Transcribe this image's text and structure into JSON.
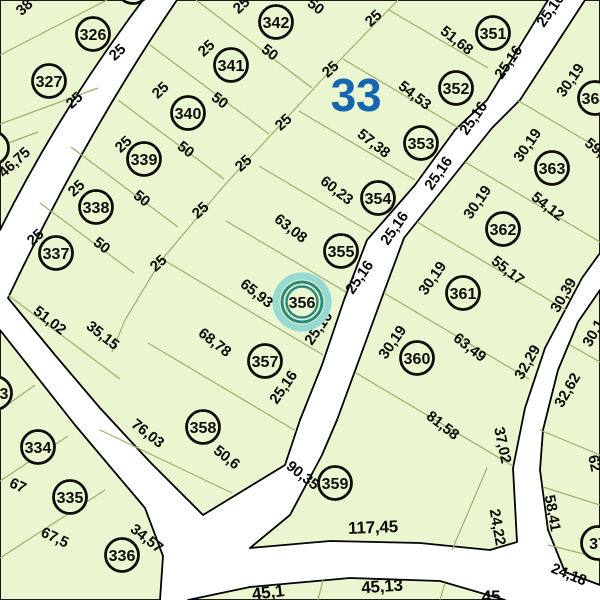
{
  "map": {
    "block_number": "33",
    "colors": {
      "parcel_fill": "#eaf6cf",
      "road": "#ffffff",
      "block_number_blue": "#1566b0",
      "highlight_teal_dark": "#2a8a7e",
      "highlight_teal_light": "#96d9d1",
      "highlight_text": "#1e7066",
      "line_olive": "#9fae6e",
      "text": "#0a0a0a"
    },
    "selected_parcel": "356",
    "parcel_markers": [
      {
        "num": "326",
        "x": 93,
        "y": 34
      },
      {
        "num": "327",
        "x": 49,
        "y": 81
      },
      {
        "num": "333",
        "x": -5,
        "y": 393
      },
      {
        "num": "334",
        "x": 38,
        "y": 447
      },
      {
        "num": "335",
        "x": 70,
        "y": 497
      },
      {
        "num": "336",
        "x": 122,
        "y": 555
      },
      {
        "num": "337",
        "x": 56,
        "y": 253
      },
      {
        "num": "338",
        "x": 96,
        "y": 207
      },
      {
        "num": "339",
        "x": 144,
        "y": 159
      },
      {
        "num": "340",
        "x": 188,
        "y": 113
      },
      {
        "num": "341",
        "x": 231,
        "y": 65
      },
      {
        "num": "342",
        "x": 276,
        "y": 22
      },
      {
        "num": "351",
        "x": 493,
        "y": 33
      },
      {
        "num": "352",
        "x": 456,
        "y": 88
      },
      {
        "num": "353",
        "x": 421,
        "y": 143
      },
      {
        "num": "354",
        "x": 378,
        "y": 198
      },
      {
        "num": "355",
        "x": 341,
        "y": 251
      },
      {
        "num": "356",
        "x": 302,
        "y": 302,
        "highlighted": true
      },
      {
        "num": "357",
        "x": 265,
        "y": 361
      },
      {
        "num": "358",
        "x": 203,
        "y": 427
      },
      {
        "num": "359",
        "x": 335,
        "y": 483
      },
      {
        "num": "360",
        "x": 417,
        "y": 358
      },
      {
        "num": "361",
        "x": 463,
        "y": 293
      },
      {
        "num": "362",
        "x": 503,
        "y": 229
      },
      {
        "num": "363",
        "x": 552,
        "y": 168
      },
      {
        "num": "364",
        "x": 595,
        "y": 98
      },
      {
        "num": "37",
        "x": 598,
        "y": 543
      }
    ],
    "partial_circles": [
      {
        "x": 133,
        "y": -13
      },
      {
        "x": -8,
        "y": 148
      }
    ],
    "dimension_labels": [
      {
        "t": "38",
        "x": 24,
        "y": 7,
        "r": -42
      },
      {
        "t": "25",
        "x": 117,
        "y": 52,
        "r": -42
      },
      {
        "t": "25",
        "x": 74,
        "y": 100,
        "r": -42
      },
      {
        "t": "46,75",
        "x": 14,
        "y": 162,
        "r": -42
      },
      {
        "t": "25",
        "x": 241,
        "y": 5,
        "r": -42
      },
      {
        "t": "25",
        "x": 206,
        "y": 48,
        "r": -42
      },
      {
        "t": "25",
        "x": 160,
        "y": 90,
        "r": -42
      },
      {
        "t": "25",
        "x": 123,
        "y": 144,
        "r": -42
      },
      {
        "t": "25",
        "x": 76,
        "y": 188,
        "r": -42
      },
      {
        "t": "25",
        "x": 35,
        "y": 237,
        "r": -42
      },
      {
        "t": "25",
        "x": 373,
        "y": 18,
        "r": -42
      },
      {
        "t": "25",
        "x": 330,
        "y": 69,
        "r": -42
      },
      {
        "t": "25",
        "x": 283,
        "y": 122,
        "r": -42
      },
      {
        "t": "25",
        "x": 243,
        "y": 163,
        "r": -42
      },
      {
        "t": "25",
        "x": 200,
        "y": 210,
        "r": -42
      },
      {
        "t": "25",
        "x": 158,
        "y": 263,
        "r": -42
      },
      {
        "t": "50",
        "x": 316,
        "y": 6,
        "r": 38
      },
      {
        "t": "50",
        "x": 270,
        "y": 52,
        "r": 38
      },
      {
        "t": "50",
        "x": 220,
        "y": 100,
        "r": 38
      },
      {
        "t": "50",
        "x": 186,
        "y": 149,
        "r": 38
      },
      {
        "t": "50",
        "x": 142,
        "y": 198,
        "r": 38
      },
      {
        "t": "50",
        "x": 102,
        "y": 245,
        "r": 38
      },
      {
        "t": "51,68",
        "x": 457,
        "y": 40,
        "r": 38
      },
      {
        "t": "54,53",
        "x": 415,
        "y": 95,
        "r": 38
      },
      {
        "t": "57,38",
        "x": 374,
        "y": 143,
        "r": 38
      },
      {
        "t": "60,23",
        "x": 337,
        "y": 190,
        "r": 38
      },
      {
        "t": "63,08",
        "x": 291,
        "y": 228,
        "r": 38
      },
      {
        "t": "65,93",
        "x": 257,
        "y": 293,
        "r": 38
      },
      {
        "t": "68,78",
        "x": 215,
        "y": 342,
        "r": 38
      },
      {
        "t": "76,03",
        "x": 148,
        "y": 433,
        "r": 38
      },
      {
        "t": "50,6",
        "x": 227,
        "y": 457,
        "r": 38
      },
      {
        "t": "90,35",
        "x": 303,
        "y": 475,
        "r": 38
      },
      {
        "t": "34,57",
        "x": 147,
        "y": 538,
        "r": 38
      },
      {
        "t": "51,02",
        "x": 50,
        "y": 320,
        "r": 38
      },
      {
        "t": "35,15",
        "x": 103,
        "y": 335,
        "r": 38
      },
      {
        "t": "67,5",
        "x": 55,
        "y": 537,
        "r": 25
      },
      {
        "t": "67",
        "x": 18,
        "y": 485,
        "r": 25
      },
      {
        "t": "25,16",
        "x": 508,
        "y": 62,
        "r": -55
      },
      {
        "t": "25,16",
        "x": 473,
        "y": 118,
        "r": -55
      },
      {
        "t": "25,16",
        "x": 438,
        "y": 173,
        "r": -55
      },
      {
        "t": "25,16",
        "x": 394,
        "y": 228,
        "r": -55
      },
      {
        "t": "25,16",
        "x": 359,
        "y": 277,
        "r": -55
      },
      {
        "t": "25,16",
        "x": 318,
        "y": 328,
        "r": -55
      },
      {
        "t": "25,16",
        "x": 283,
        "y": 387,
        "r": -55
      },
      {
        "t": "25,16",
        "x": 550,
        "y": 10,
        "r": -55
      },
      {
        "t": "30,19",
        "x": 570,
        "y": 80,
        "r": -55
      },
      {
        "t": "30,19",
        "x": 527,
        "y": 145,
        "r": -55
      },
      {
        "t": "30,19",
        "x": 477,
        "y": 202,
        "r": -55
      },
      {
        "t": "30,19",
        "x": 432,
        "y": 278,
        "r": -55
      },
      {
        "t": "30,19",
        "x": 392,
        "y": 342,
        "r": -55
      },
      {
        "t": "54,12",
        "x": 548,
        "y": 206,
        "r": 38
      },
      {
        "t": "55,17",
        "x": 508,
        "y": 270,
        "r": 38
      },
      {
        "t": "63,49",
        "x": 470,
        "y": 347,
        "r": 38
      },
      {
        "t": "81,58",
        "x": 443,
        "y": 425,
        "r": 38
      },
      {
        "t": "59,",
        "x": 595,
        "y": 147,
        "r": 38
      },
      {
        "t": "37,02",
        "x": 503,
        "y": 445,
        "r": 78
      },
      {
        "t": "24,22",
        "x": 498,
        "y": 527,
        "r": 80
      },
      {
        "t": "58,41",
        "x": 553,
        "y": 513,
        "r": 80
      },
      {
        "t": "62",
        "x": 595,
        "y": 463,
        "r": 78
      },
      {
        "t": "30,39",
        "x": 563,
        "y": 295,
        "r": -60
      },
      {
        "t": "32,29",
        "x": 527,
        "y": 362,
        "r": -60
      },
      {
        "t": "32,62",
        "x": 567,
        "y": 390,
        "r": -60
      },
      {
        "t": "30,1",
        "x": 593,
        "y": 333,
        "r": -60
      },
      {
        "t": "24,18",
        "x": 569,
        "y": 574,
        "r": 22
      },
      {
        "t": "117,45",
        "x": 373,
        "y": 527,
        "r": -2,
        "fs": 17
      },
      {
        "t": "45,1",
        "x": 268,
        "y": 592,
        "r": -7,
        "fs": 17
      },
      {
        "t": "45,13",
        "x": 382,
        "y": 586,
        "r": -4,
        "fs": 17
      },
      {
        "t": "45",
        "x": 491,
        "y": 596,
        "r": 0,
        "fs": 17
      },
      {
        "t": "33",
        "x": 356,
        "y": 95,
        "r": 0,
        "fs": 46,
        "c": "#1566b0"
      }
    ]
  }
}
